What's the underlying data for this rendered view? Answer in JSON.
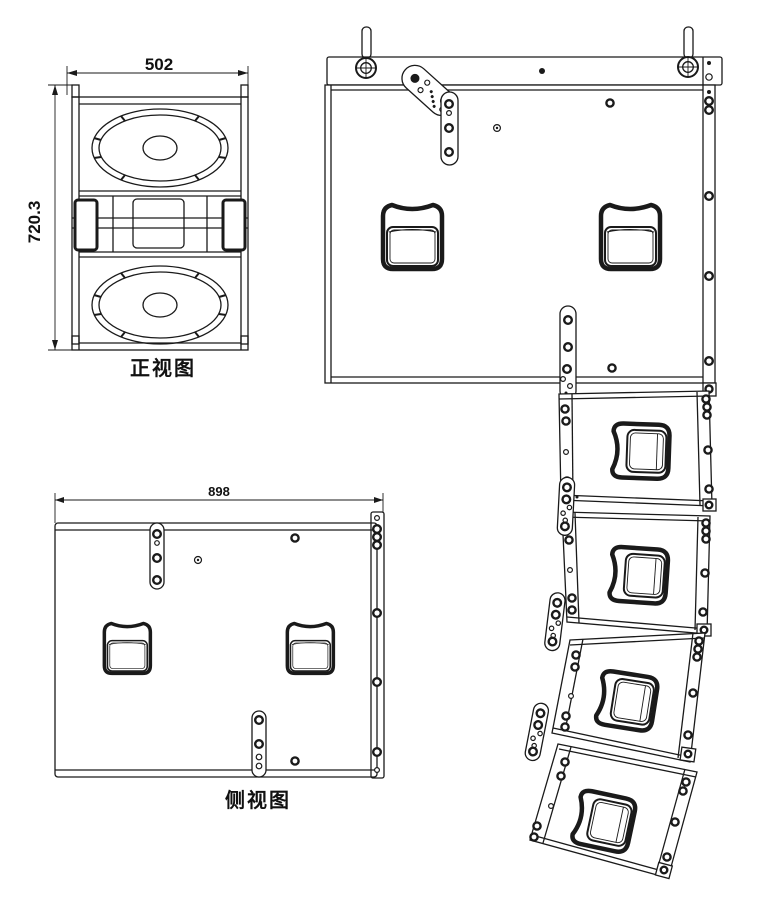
{
  "colors": {
    "background": "#ffffff",
    "line": "#1a1a1a"
  },
  "front_view": {
    "label": "正视图",
    "width_dim": "502",
    "height_dim": "720.3"
  },
  "side_view": {
    "label": "侧视图",
    "width_dim": "898"
  },
  "array_view": {
    "module_count": 4
  }
}
